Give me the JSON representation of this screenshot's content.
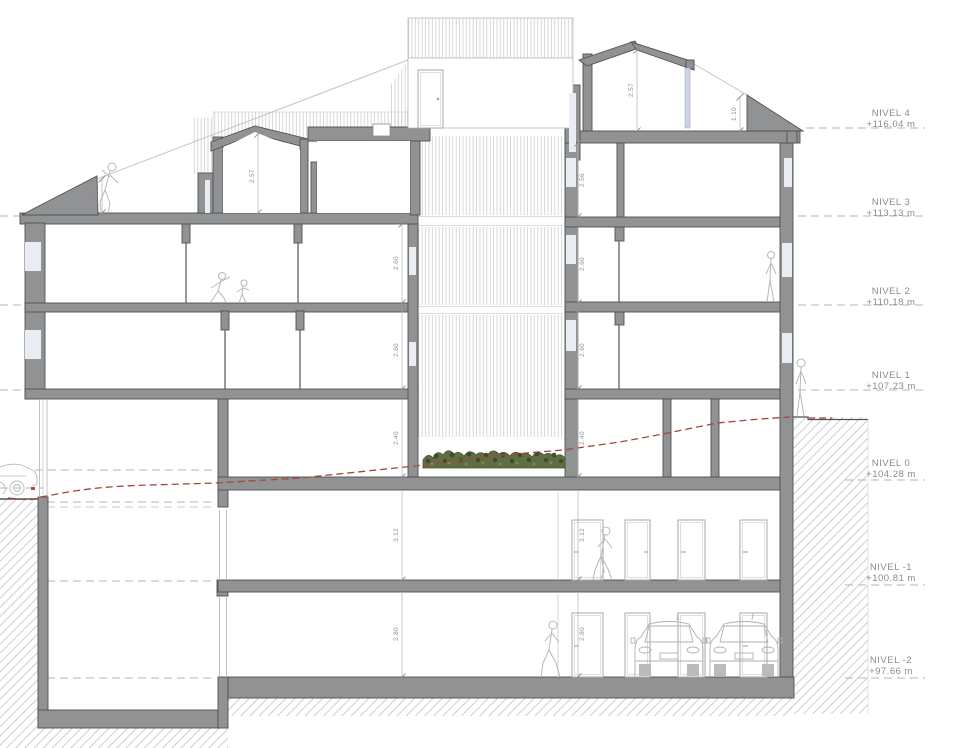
{
  "drawing": {
    "levels": [
      {
        "name": "NIVEL 4",
        "elevation": "+116.04 m"
      },
      {
        "name": "NIVEL 3",
        "elevation": "+113.13 m"
      },
      {
        "name": "NIVEL 2",
        "elevation": "+110.18 m"
      },
      {
        "name": "NIVEL 1",
        "elevation": "+107.23 m"
      },
      {
        "name": "NIVEL 0",
        "elevation": "+104.28 m"
      },
      {
        "name": "NIVEL -1",
        "elevation": "+100.81 m"
      },
      {
        "name": "NIVEL -2",
        "elevation": "+97.66 m"
      }
    ],
    "dimensions": {
      "attic_room": "2.57",
      "attic_parapet": "1.10",
      "roof_room": "2.57",
      "roof_parapet": "1.10",
      "right_chain": [
        "2.56",
        "2.60",
        "2.60",
        "2.40",
        "3.12",
        "2.80"
      ],
      "left_chain": [
        "2.60",
        "2.60",
        "2.40",
        "3.12",
        "2.80"
      ]
    },
    "colors": {
      "wall_gray": "#909294",
      "terrain_line_red": "#a8453c",
      "vegetation_green": "#5f6d42",
      "hatch_gray": "#c9cbcc"
    }
  }
}
